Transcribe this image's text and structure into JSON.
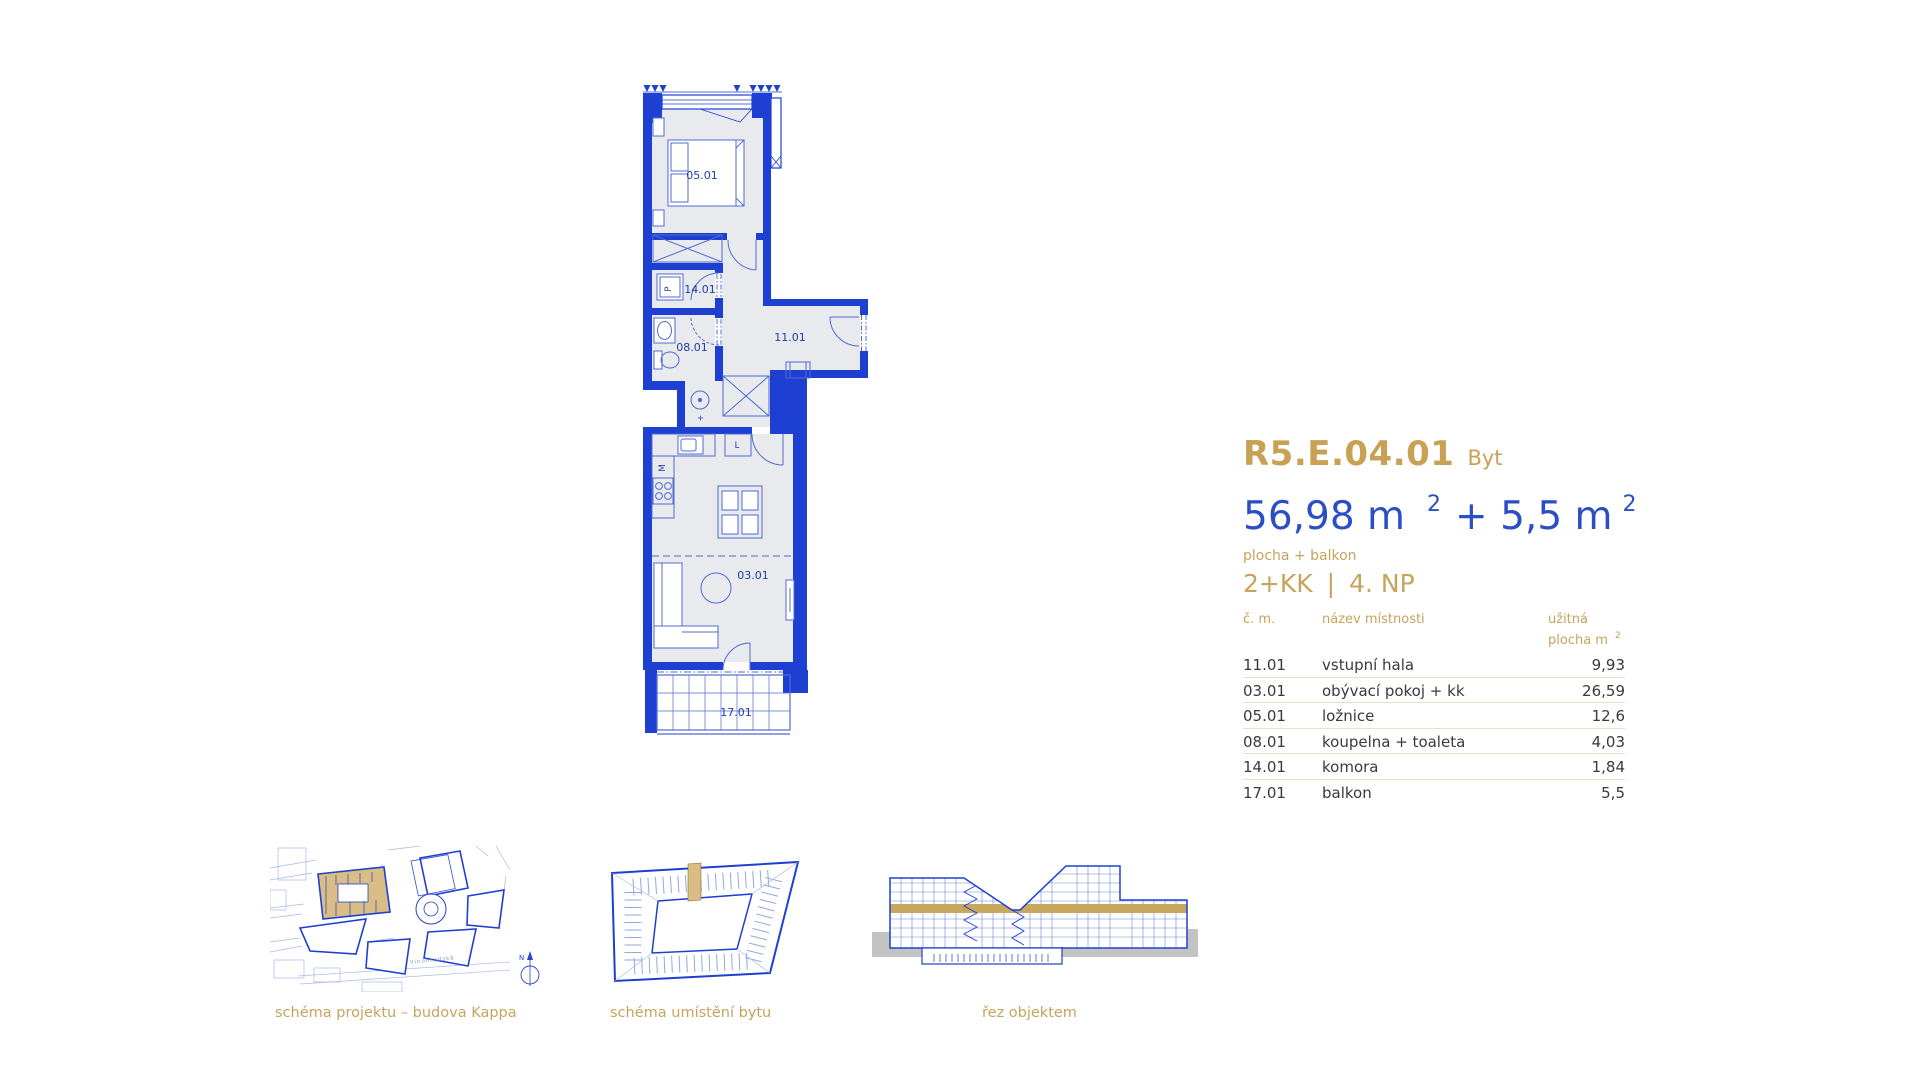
{
  "unit": {
    "code": "R5.E.04.01",
    "type_label": "Byt",
    "area_value_1": "56,98 m",
    "area_sup_1": "2",
    "area_value_2": "+ 5,5 m",
    "area_sup_2": "2",
    "area_note": "plocha + balkon",
    "disposition": "2+KK",
    "separator": "|",
    "floor": "4. NP"
  },
  "room_table": {
    "header_number": "č. m.",
    "header_name": "název místnosti",
    "header_area_line1": "užitná",
    "header_area_line2": "plocha m",
    "header_area_sup": "2",
    "rows": [
      {
        "number": "11.01",
        "name": "vstupní hala",
        "area": "9,93"
      },
      {
        "number": "03.01",
        "name": "obývací pokoj + kk",
        "area": "26,59"
      },
      {
        "number": "05.01",
        "name": "ložnice",
        "area": "12,6"
      },
      {
        "number": "08.01",
        "name": "koupelna + toaleta",
        "area": "4,03"
      },
      {
        "number": "14.01",
        "name": "komora",
        "area": "1,84"
      },
      {
        "number": "17.01",
        "name": "balkon",
        "area": "5,5"
      }
    ]
  },
  "floorplan_labels": {
    "bedroom": "05.01",
    "storage": "14.01",
    "bathroom": "08.01",
    "hall": "11.01",
    "living": "03.01",
    "balcony": "17.01",
    "washer": "P",
    "dishwasher": "M",
    "fridge": "L"
  },
  "schematics": {
    "site_caption": "schéma projektu – budova Kappa",
    "site_street": "Vinohradská",
    "location_caption": "schéma umístění bytu",
    "section_caption": "řez objektem",
    "compass_label": "N"
  },
  "colors": {
    "gold": "#C7A35D",
    "gold_fill": "#D9BD85",
    "blue_text": "#2B4EC5",
    "wall_blue": "#1E40D2",
    "furniture_blue": "#4F6BD2",
    "light_blue": "#7E95DC",
    "room_fill": "#E9EAEE",
    "label_blue": "#1D3EA8",
    "table_text": "#3A3A3A",
    "divider": "#EADFC6",
    "ground_gray": "#C3C3C3"
  }
}
